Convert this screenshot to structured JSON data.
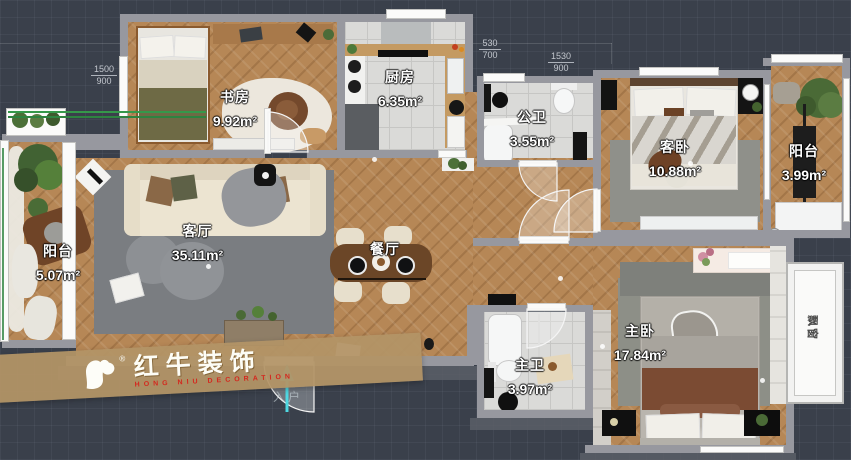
{
  "colors": {
    "background": "#3a404b",
    "wall": "#97989f",
    "wood_floor": "#b68756",
    "tile_floor": "#dadad8",
    "rug_gray": "#7a7d81",
    "entry_arrow": "#4fd8e2",
    "watermark_band": "#b29366",
    "watermark_red": "#d4281e",
    "window_green_line": "#2e8340"
  },
  "rooms": [
    {
      "id": "study",
      "name": "书房",
      "area": "9.92m²"
    },
    {
      "id": "kitchen",
      "name": "厨房",
      "area": "6.35m²"
    },
    {
      "id": "public-bath",
      "name": "公卫",
      "area": "3.55m²"
    },
    {
      "id": "guest-bedroom",
      "name": "客卧",
      "area": "10.88m²"
    },
    {
      "id": "balcony-right",
      "name": "阳台",
      "area": "3.99m²"
    },
    {
      "id": "balcony-left",
      "name": "阳台",
      "area": "5.07m²"
    },
    {
      "id": "living-room",
      "name": "客厅",
      "area": "35.11m²"
    },
    {
      "id": "dining-room",
      "name": "餐厅",
      "area": ""
    },
    {
      "id": "master-bath",
      "name": "主卫",
      "area": "3.97m²"
    },
    {
      "id": "master-bedroom",
      "name": "主卧",
      "area": "17.84m²"
    },
    {
      "id": "bay-window",
      "name": "飘窗",
      "area": ""
    }
  ],
  "dimensions": [
    {
      "id": "dim-left",
      "num": "1500",
      "den": "900"
    },
    {
      "id": "dim-mid",
      "num": "530",
      "den": "700"
    },
    {
      "id": "dim-right",
      "num": "1530",
      "den": "900"
    }
  ],
  "entry": {
    "label": "入户"
  },
  "watermark": {
    "brand": "红牛装饰",
    "subtitle": "HONG NIU DECORATION",
    "reg": "®"
  }
}
